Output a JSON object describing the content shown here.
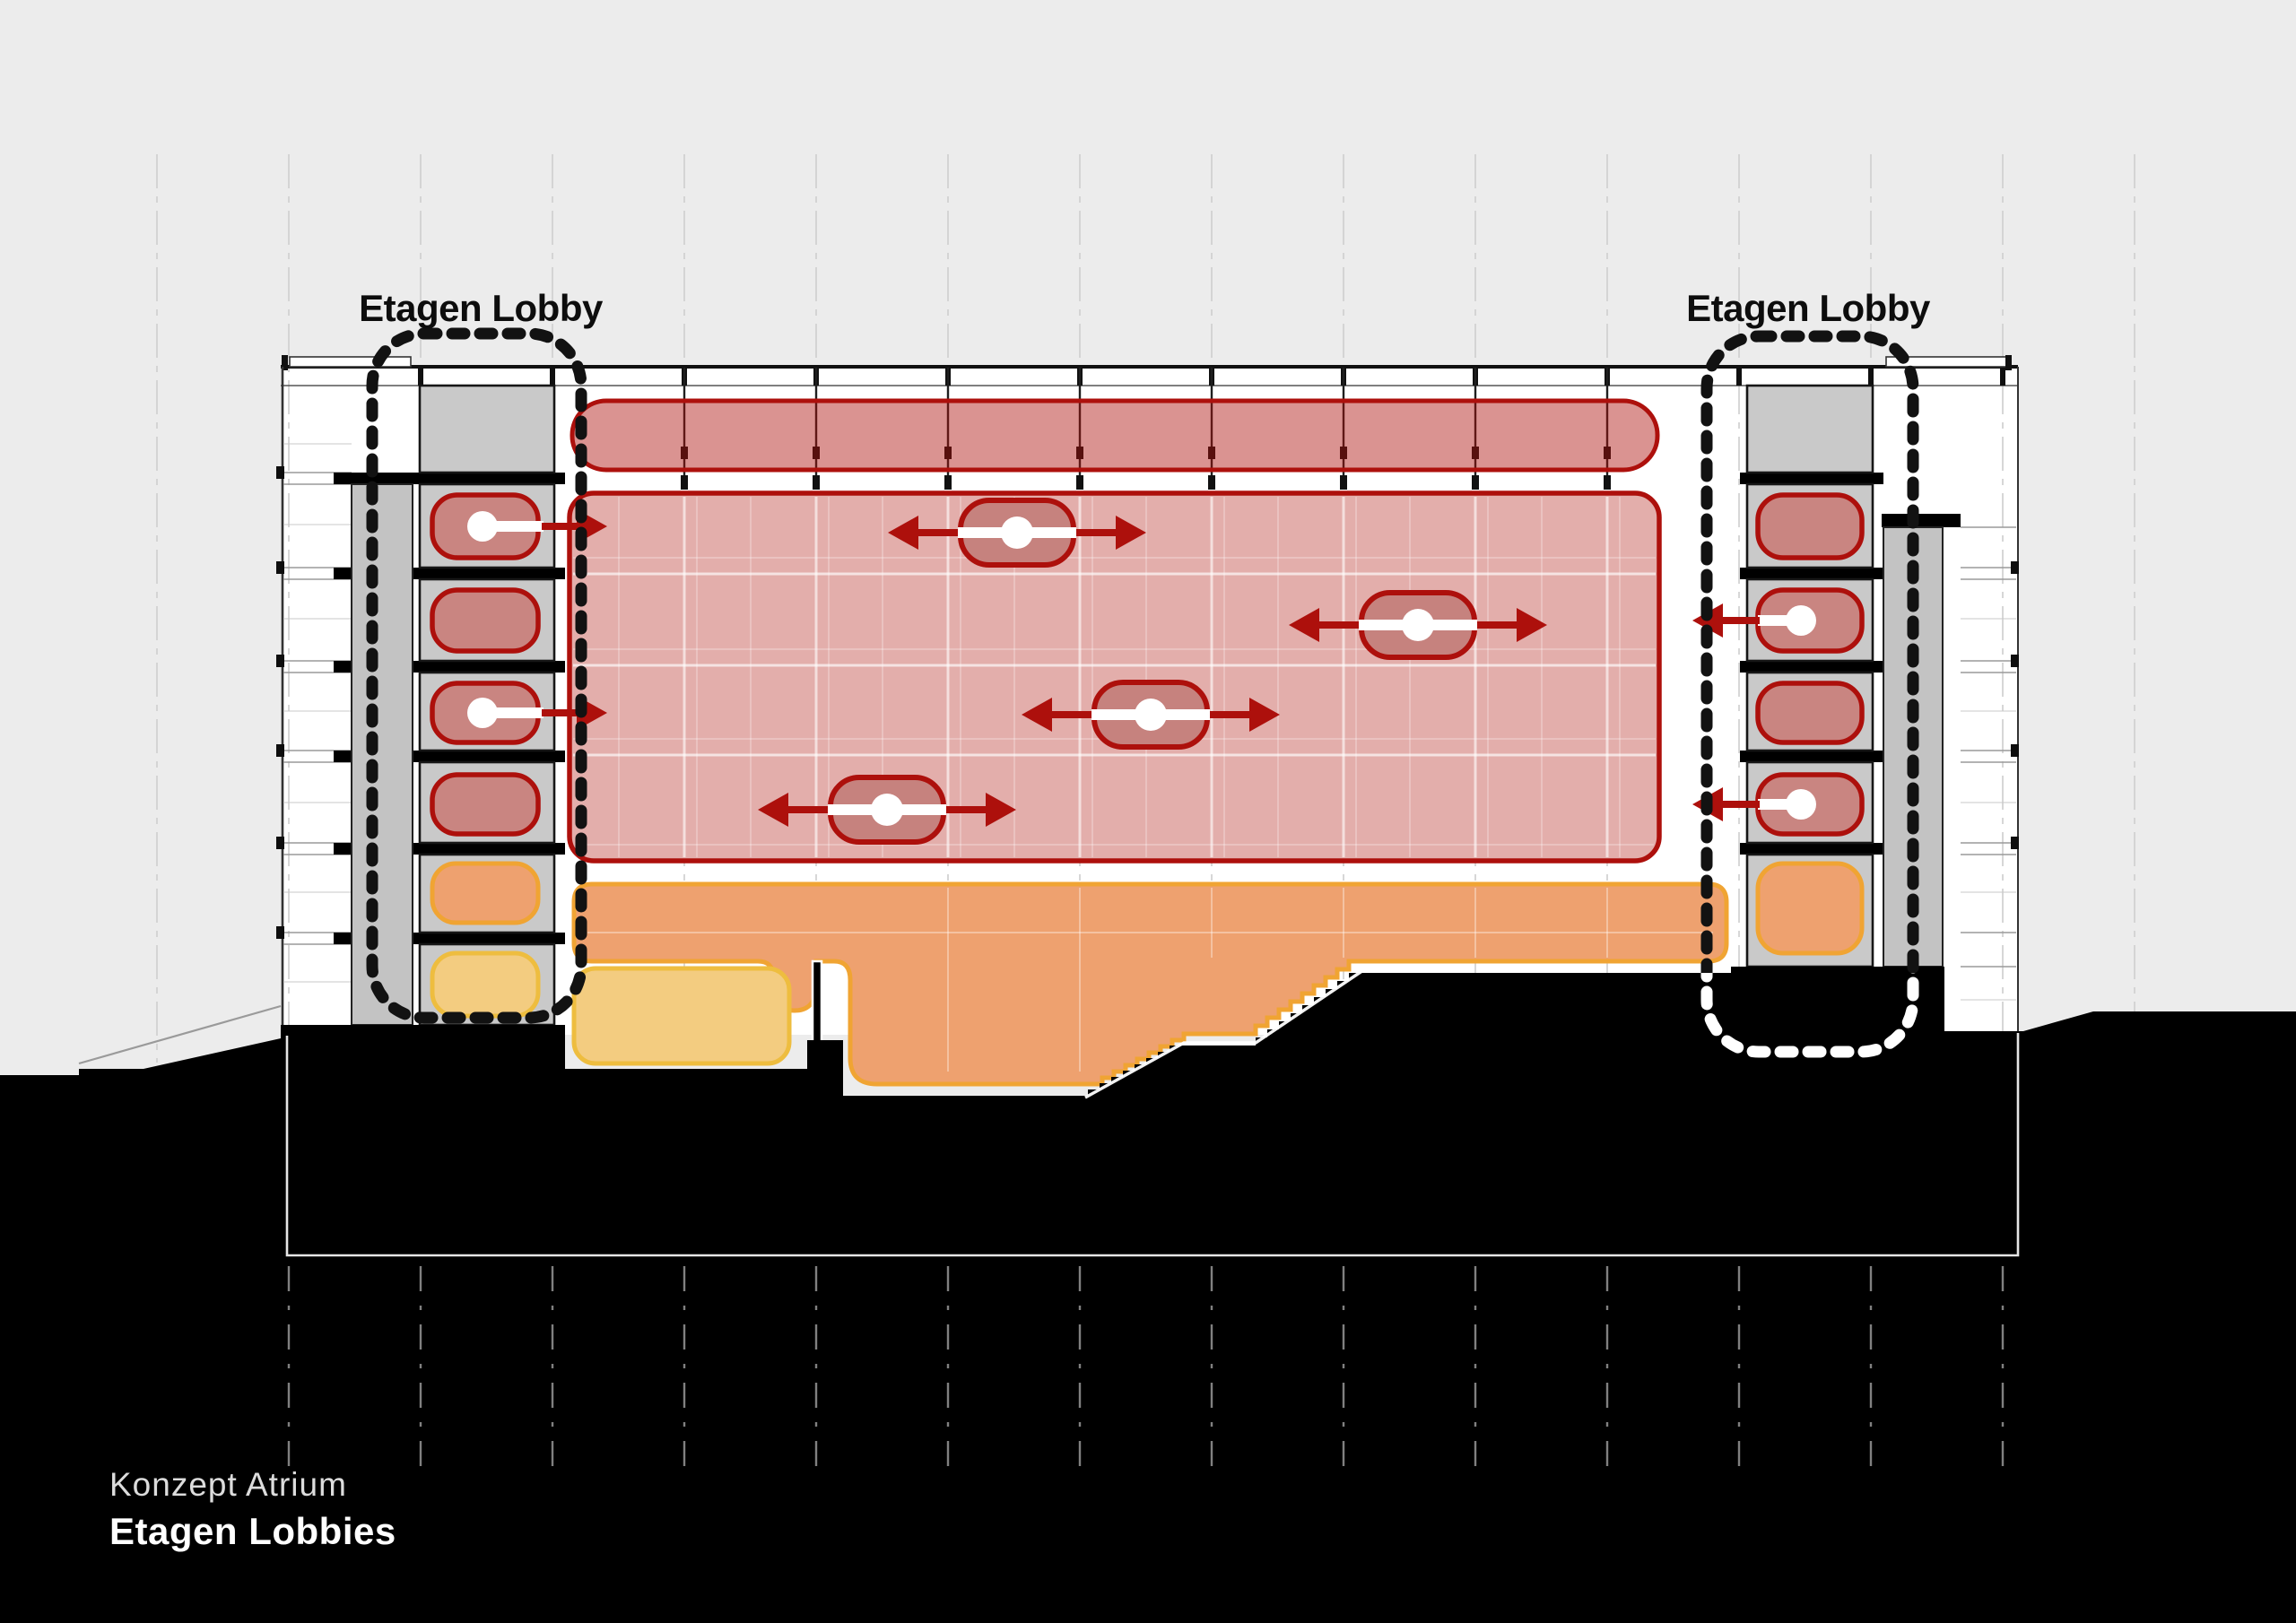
{
  "title_labels": {
    "left": "Etagen Lobby",
    "right": "Etagen Lobby"
  },
  "caption": {
    "line1": "Konzept Atrium",
    "line2": "Etagen Lobbies"
  },
  "colors": {
    "bg": "#ececec",
    "ink": "#0d0d0d",
    "accent-red": "#ad100c",
    "atrium-pink": "#e3aeab",
    "band-red": "#c4706c",
    "box-red": "#c98581",
    "tower-gray": "#c9c9c9",
    "shaft-gray": "#c3c3c3",
    "orange-fill": "#eea16f",
    "orange-stroke": "#f0a433",
    "yellow-fill": "#f3cc80",
    "yellow-stroke": "#eebd3f",
    "ground-black": "#000000",
    "caption-light": "#dcdcdc",
    "caption-white": "#ffffff",
    "grid-line": "#d0d0d0"
  },
  "icons": {
    "flow_arrow": "double-headed-arrow",
    "lobby_marker": "white-dot-node",
    "lobby_outline": "dashed-rounded-loop"
  }
}
